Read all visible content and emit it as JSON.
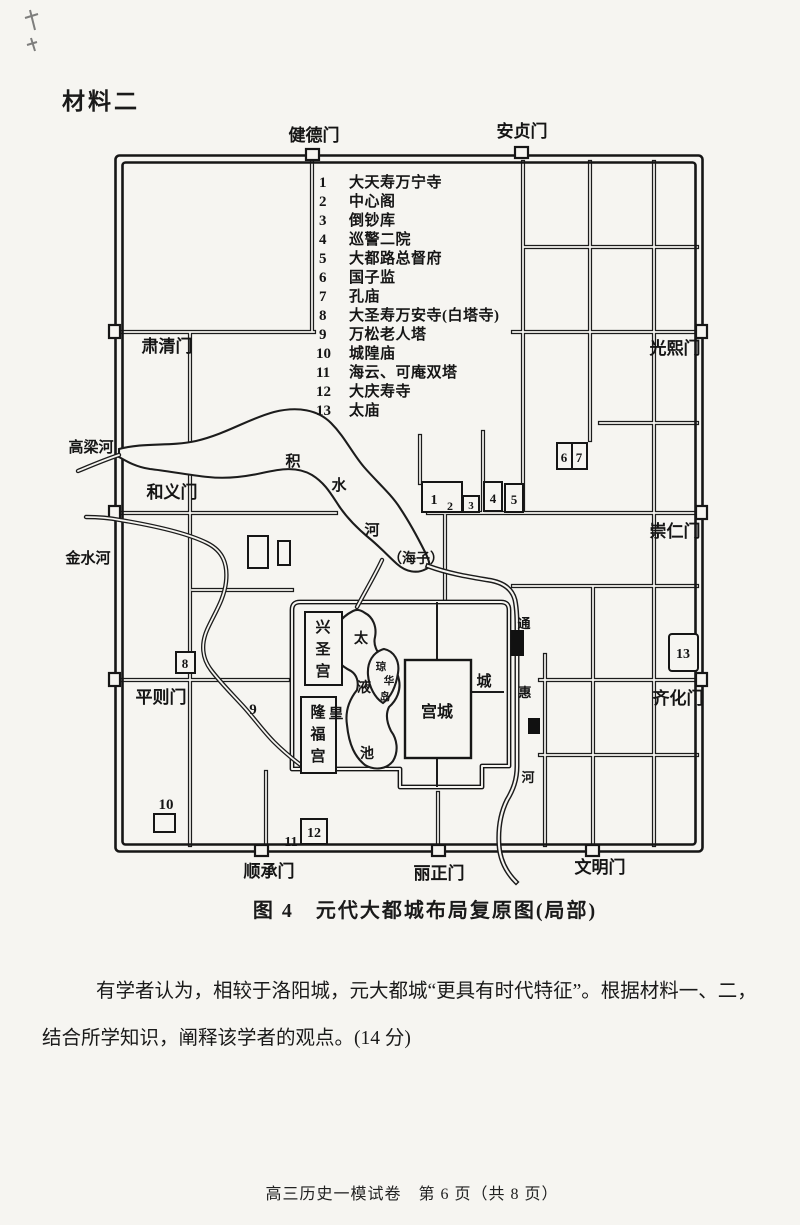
{
  "page": {
    "heading": "材料二",
    "caption": "图 4　元代大都城布局复原图(局部)",
    "footer": "高三历史一模试卷　第 6 页（共 8 页）"
  },
  "question": {
    "line1": "有学者认为，相较于洛阳城，元大都城“更具有时代特征”。根据材料一、二，",
    "line2": "结合所学知识，阐释该学者的观点。(14 分)"
  },
  "legend": {
    "items": [
      {
        "no": "1",
        "label": "大天寿万宁寺"
      },
      {
        "no": "2",
        "label": "中心阁"
      },
      {
        "no": "3",
        "label": "倒钞库"
      },
      {
        "no": "4",
        "label": "巡警二院"
      },
      {
        "no": "5",
        "label": "大都路总督府"
      },
      {
        "no": "6",
        "label": "国子监"
      },
      {
        "no": "7",
        "label": "孔庙"
      },
      {
        "no": "8",
        "label": "大圣寿万安寺(白塔寺)"
      },
      {
        "no": "9",
        "label": "万松老人塔"
      },
      {
        "no": "10",
        "label": "城隍庙"
      },
      {
        "no": "11",
        "label": "海云、可庵双塔"
      },
      {
        "no": "12",
        "label": "大庆寿寺"
      },
      {
        "no": "13",
        "label": "太庙"
      }
    ]
  },
  "map": {
    "gates": {
      "jiande": "健德门",
      "anzhen": "安贞门",
      "suqing": "肃清门",
      "heyi": "和义门",
      "pingze": "平则门",
      "guangxi": "光熙门",
      "chongren": "崇仁门",
      "qihua": "齐化门",
      "shuncheng": "顺承门",
      "lizheng": "丽正门",
      "wenming": "文明门"
    },
    "rivers": {
      "gaoliang": "高梁河",
      "jinshui": "金水河",
      "jishui": "积水河",
      "haizi": "（海子）",
      "tonghui": "通惠河"
    },
    "palace": {
      "gongcheng": "宫城",
      "huangcheng": "皇城",
      "xingsheng": "兴圣宫",
      "longfu": "隆福宫",
      "taiye": "太液池",
      "qionghua": "琼华岛"
    },
    "markers": {
      "m1": "1",
      "m2": "2",
      "m3": "3",
      "m4": "4",
      "m5": "5",
      "m6": "6",
      "m7": "7",
      "m8": "8",
      "m9": "9",
      "m10": "10",
      "m11": "11",
      "m12": "12",
      "m13": "13"
    }
  }
}
